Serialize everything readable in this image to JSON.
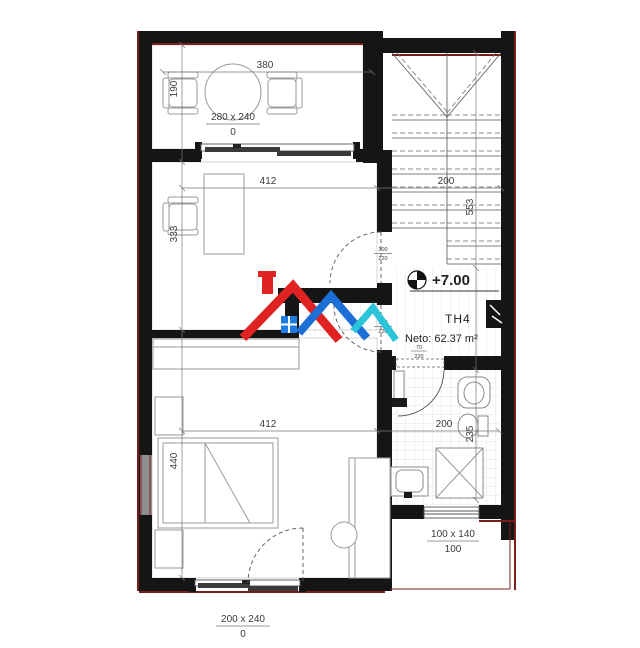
{
  "plan": {
    "unit": "TH4",
    "level": "+7.00",
    "area": "Neto: 62.37 m²",
    "dims": {
      "terrace_width": "380",
      "terrace_depth": "190",
      "study_width": "412",
      "study_depth": "333",
      "bedroom_width": "412",
      "bedroom_depth": "440",
      "stair_width": "200",
      "stair_length": "553",
      "bath_width": "200",
      "bath_depth": "235"
    },
    "openings": {
      "terrace_door": {
        "size": "280 x 240",
        "sill": "0"
      },
      "bedroom_door": {
        "size": "200 x 240",
        "sill": "0"
      },
      "bath_window": {
        "size": "100 x 140",
        "sill": "100"
      },
      "door_study": {
        "w": "100",
        "h": "220"
      },
      "door_bedroom": {
        "w": "100",
        "h": "220"
      },
      "door_bath": {
        "w": "70",
        "h": "220"
      }
    },
    "colors": {
      "wall": "#151515",
      "accent": "#7a1d1d",
      "dim": "#3c3c3c",
      "logo_red": "#e02222",
      "logo_blue": "#1b6fd6",
      "logo_teal": "#2bc4d9",
      "logo_window": "#1e7be0"
    }
  }
}
